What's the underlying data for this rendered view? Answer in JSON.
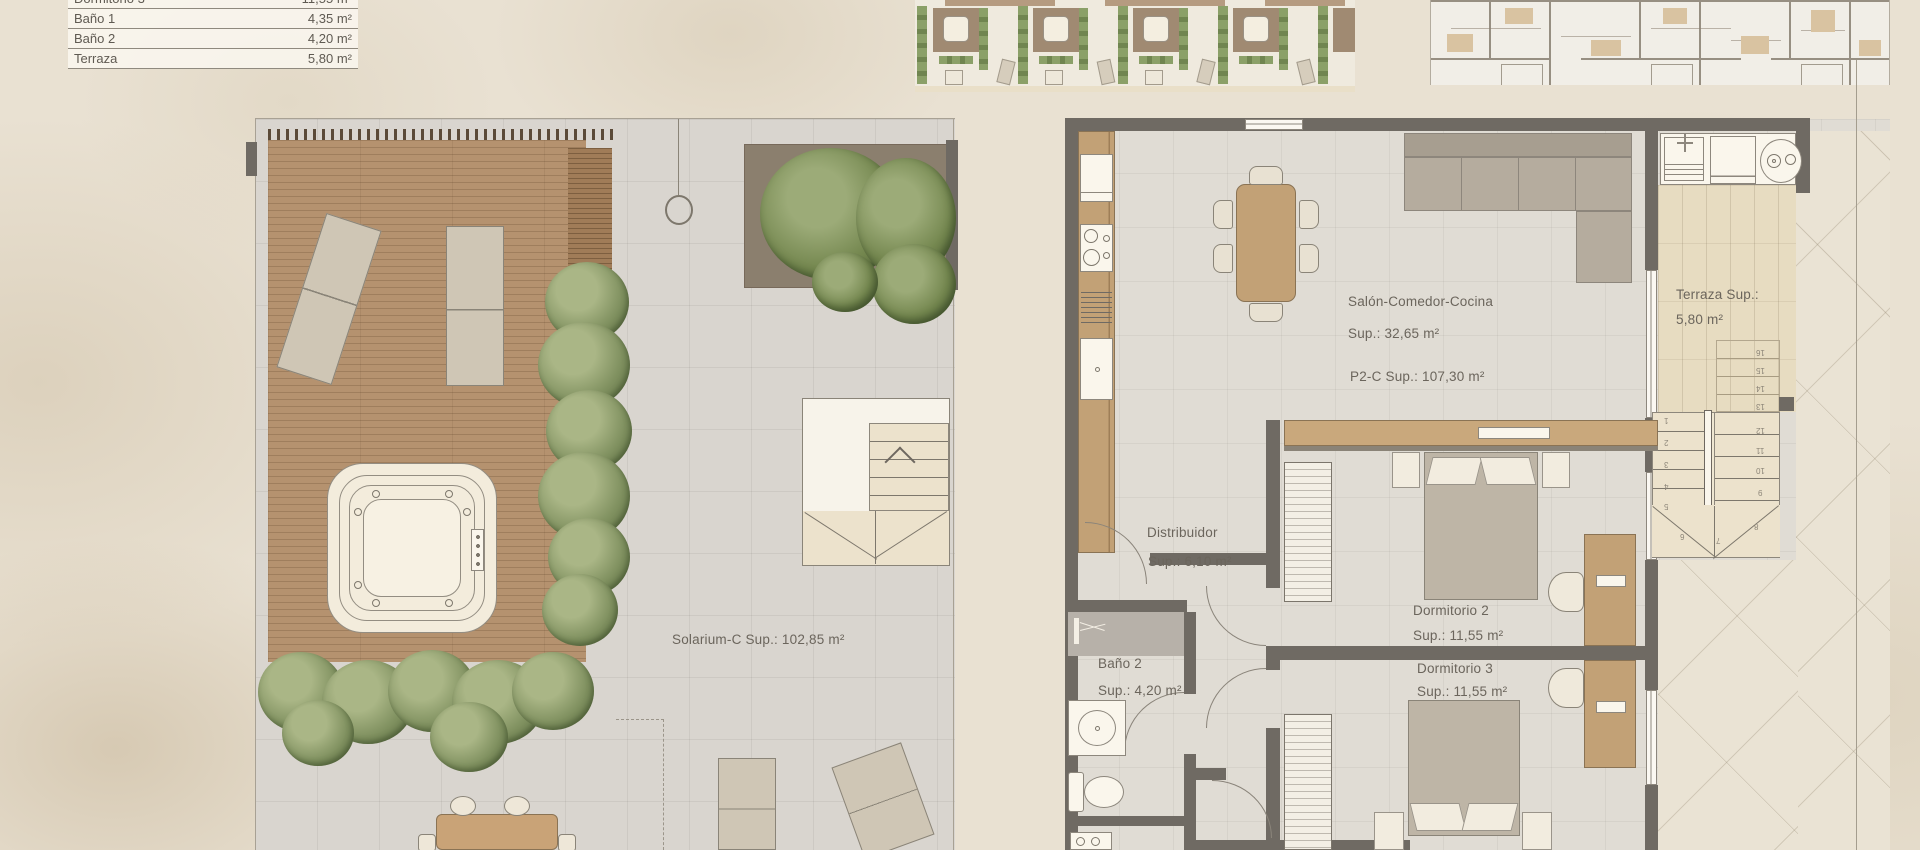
{
  "area_table": {
    "rows": [
      {
        "label": "Dormitorio 3",
        "value": "11,55 m²"
      },
      {
        "label": "Baño 1",
        "value": "4,35 m²"
      },
      {
        "label": "Baño 2",
        "value": "4,20 m²"
      },
      {
        "label": "Terraza",
        "value": "5,80 m²"
      }
    ]
  },
  "left_plan": {
    "area_label": "Solarium-C Sup.: 102,85 m²"
  },
  "right_plan": {
    "total_label": "P2-C Sup.: 107,30 m²",
    "living": {
      "name": "Salón-Comedor-Cocina",
      "area": "Sup.: 32,65 m²"
    },
    "hall": {
      "name": "Distribuidor",
      "area": "Sup.: 6,10 m²"
    },
    "bath2": {
      "name": "Baño 2",
      "area": "Sup.: 4,20 m²"
    },
    "bedroom2": {
      "name": "Dormitorio 2",
      "area": "Sup.: 11,55 m²"
    },
    "bedroom3": {
      "name": "Dormitorio 3",
      "area": "Sup.: 11,55 m²"
    },
    "terrace": {
      "name": "Terraza Sup.:",
      "area": "5,80 m²"
    },
    "stairs": {
      "numbers": [
        "1",
        "2",
        "3",
        "4",
        "5",
        "6",
        "7",
        "8",
        "9",
        "10",
        "11",
        "12",
        "13",
        "14",
        "15",
        "16"
      ]
    }
  },
  "colors": {
    "background": "#e9e1d2",
    "deck_wood": "#b5926f",
    "furniture_wood": "#c2a176",
    "plant_green": "#7f905f",
    "wall": "#6f6a63",
    "paving": "#d9d5cf",
    "interior_floor": "#e0dcd4",
    "terrace_floor": "#e7dcc1",
    "text": "#6b655c"
  }
}
